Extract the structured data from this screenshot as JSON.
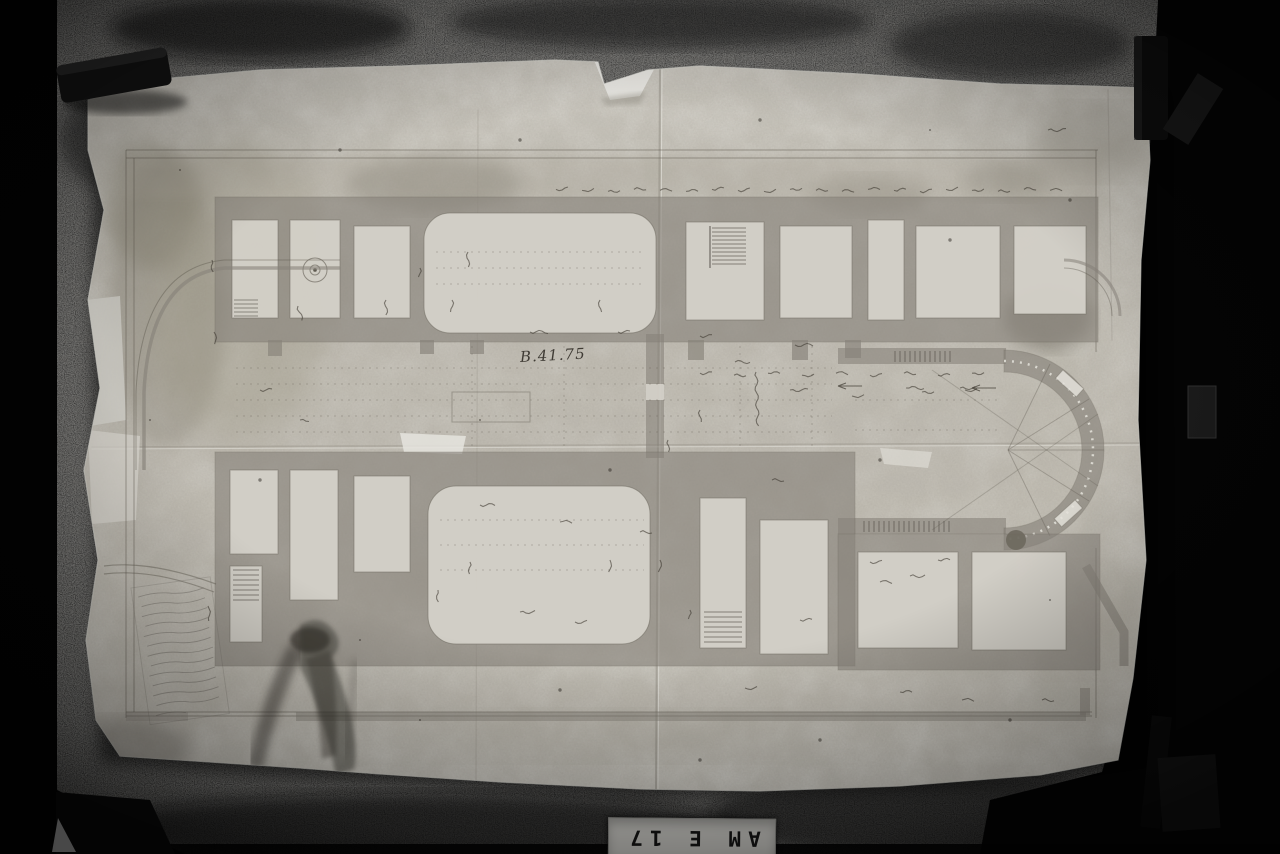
{
  "plate": {
    "text": "AM E 17"
  },
  "drawing": {
    "dimension_note": "B.41.75"
  },
  "colors": {
    "backdrop": "#000000",
    "canvas_texture": "#3c3a38",
    "paper": "#d8d6cf",
    "wall_wash": "#87827a",
    "ink": "#38342c",
    "label_plate_bg": "#d2d1cc"
  }
}
